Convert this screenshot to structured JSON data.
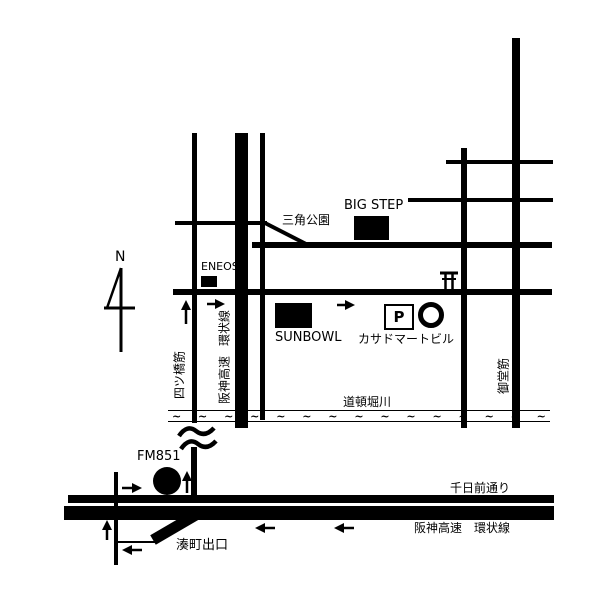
{
  "colors": {
    "ink": "#000000",
    "bg": "#ffffff"
  },
  "compass": {
    "north_label": "N"
  },
  "landmarks": {
    "big_step": {
      "label": "BIG STEP"
    },
    "triangle_park": {
      "label": "三角公園"
    },
    "eneos": {
      "label": "ENEOS"
    },
    "sunbowl": {
      "label": "SUNBOWL"
    },
    "parking": {
      "label": "P"
    },
    "kasado_mart_building": {
      "label": "カサドマートビル"
    },
    "fm851": {
      "label": "FM851"
    }
  },
  "roads": {
    "yotsubashi_suji": {
      "label": "四ツ橋筋"
    },
    "hanshin_expressway": {
      "label": "阪神高速"
    },
    "loop_line": {
      "label": "環状線"
    },
    "midosuji": {
      "label": "御堂筋"
    },
    "sennichimae_dori": {
      "label": "千日前通り"
    },
    "hanshin_expressway_loop": {
      "label": "阪神高速　環状線"
    },
    "minatomachi_exit": {
      "label": "湊町出口"
    }
  },
  "river": {
    "label": "道頓堀川",
    "wave_char": "~",
    "wave_count": 15
  }
}
